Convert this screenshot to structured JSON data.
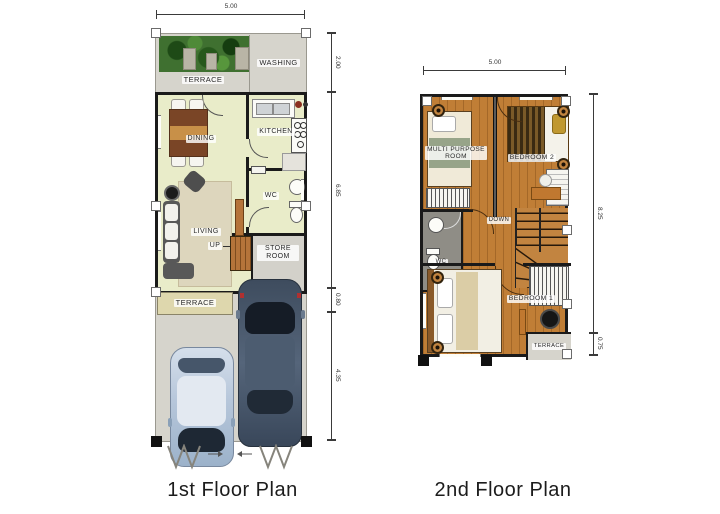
{
  "colors": {
    "wall": "#1a1a1a",
    "floor_first": "#e9ecc9",
    "concrete": "#d6d4cc",
    "terrace_beige": "#ded7ad",
    "wood_floor": "#c07e36",
    "stairs_wood": "#b5743a",
    "store_gray": "#d3d1ca",
    "wc2_gray": "#8f8d86",
    "rug": "#ddd6bd",
    "car_light_body": "#b6c6da",
    "car_dark_body": "#46566b",
    "dim_line": "#3a3a3a",
    "label_text": "#2a2a2a"
  },
  "first_floor": {
    "title": "1st Floor Plan",
    "dim_top": "5.00",
    "dims_right": [
      "2.00",
      "6.85",
      "0.80",
      "4.35"
    ],
    "labels": {
      "terrace_top": "TERRACE",
      "washing": "WASHING",
      "dining": "DINING",
      "kitchen": "KITCHEN",
      "wc": "WC",
      "living": "LIVING",
      "up": "UP",
      "store_room": "STORE ROOM",
      "terrace_front": "TERRACE"
    }
  },
  "second_floor": {
    "title": "2nd Floor Plan",
    "dim_top": "5.00",
    "dims_right": [
      "8.25",
      "0.75"
    ],
    "labels": {
      "multi_purpose_room": "MULTI PURPOSE ROOM",
      "bedroom_2": "BEDROOM 2",
      "wc": "WC",
      "down": "DOWN",
      "bedroom_1": "BEDROOM 1",
      "terrace": "TERRACE"
    }
  }
}
